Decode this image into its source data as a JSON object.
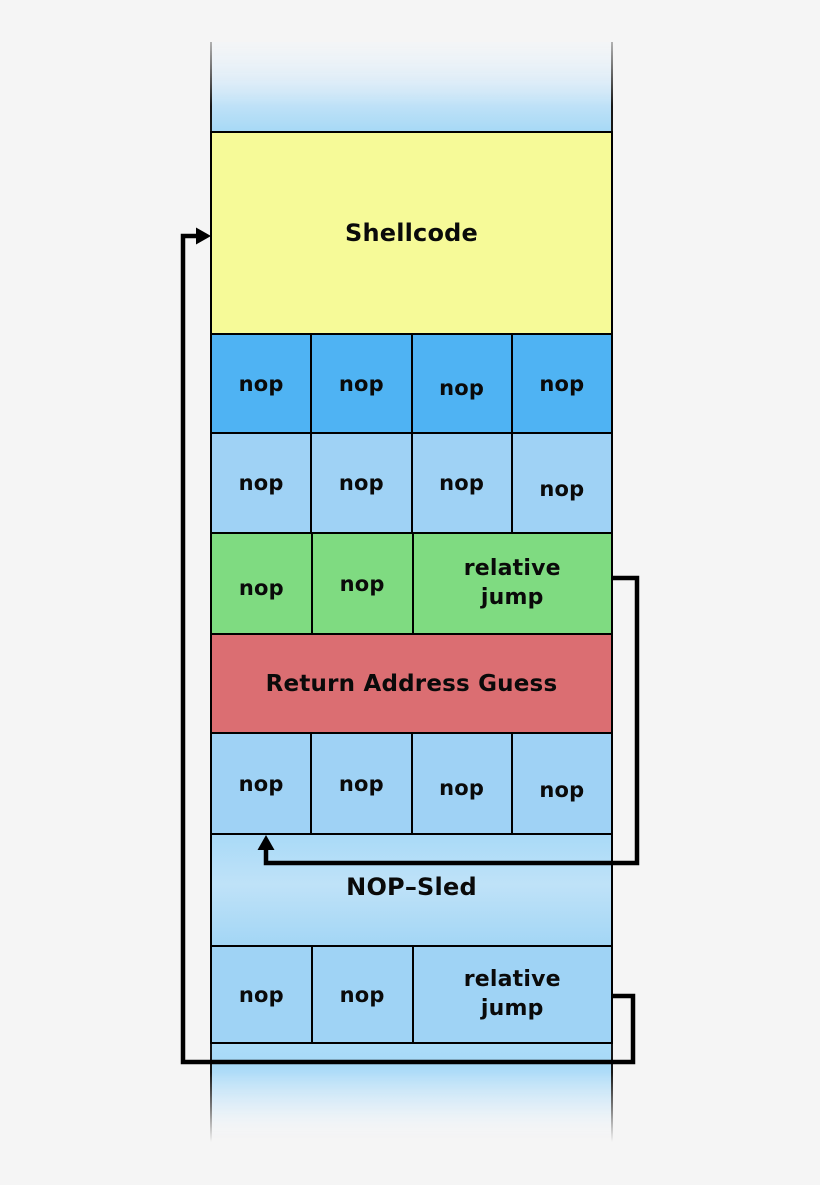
{
  "diagram": {
    "background_color": "#f5f5f5",
    "colors": {
      "shellcode_fill": "#f6fa98",
      "nop_dark_blue": "#4fb3f3",
      "nop_light_blue": "#9fd2f5",
      "jump_green": "#7fdb81",
      "return_address_red": "#db6e72",
      "sled_gradient_blue": "#a9daf7",
      "border": "#000000",
      "arrow": "#000000"
    },
    "stack": {
      "shellcode_label": "Shellcode",
      "nop_row_1": [
        "nop",
        "nop",
        "nop",
        "nop"
      ],
      "nop_row_2": [
        "nop",
        "nop",
        "nop",
        "nop"
      ],
      "green_row": {
        "cells": [
          "nop",
          "nop"
        ],
        "jump_label": "relative\njump"
      },
      "return_address_label": "Return Address Guess",
      "nop_row_3": [
        "nop",
        "nop",
        "nop",
        "nop"
      ],
      "nop_sled_label": "NOP–Sled",
      "bottom_row": {
        "cells": [
          "nop",
          "nop"
        ],
        "jump_label": "relative\njump"
      }
    }
  }
}
